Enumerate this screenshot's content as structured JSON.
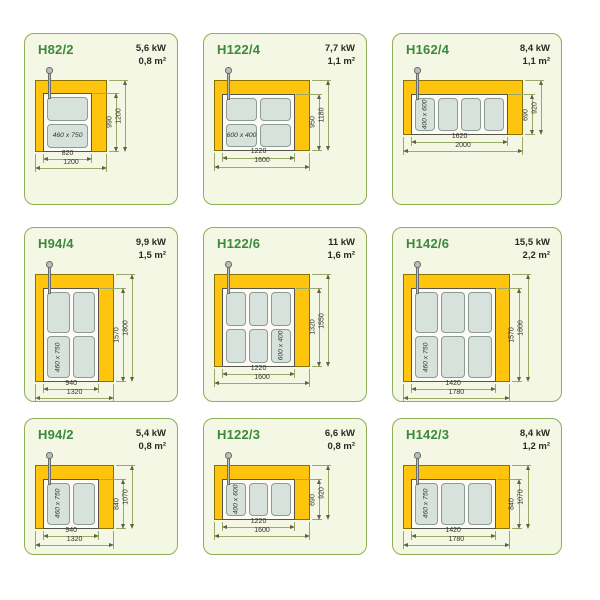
{
  "colors": {
    "page_bg": "#ffffff",
    "panel_bg": "#f4f7e4",
    "panel_border": "#8fae55",
    "title_green": "#3a8a3c",
    "spec_text": "#2b2b25",
    "frame_fill": "#ffc40d",
    "frame_border": "#8a7200",
    "recess_fill": "#fcfcf4",
    "recess_border": "#55554c",
    "plate_fill": "#d8e2dd",
    "plate_border": "#8d9b96",
    "dim_line": "#9aa868",
    "dim_arrow": "#5a6440",
    "dim_text": "#33332d",
    "chimney_fill": "#b9bdbb",
    "chimney_border": "#67706d"
  },
  "cells": [
    {
      "model": "H82/2",
      "power": "5,6 kW",
      "area": "0,8 m²",
      "frame": {
        "outer_w": 1200,
        "outer_h": 1200,
        "inner_w": 820,
        "inner_h": 990
      },
      "dims": {
        "inner_w": 820,
        "outer_w": 1200,
        "inner_h": 990,
        "outer_h": 1200
      },
      "plates": {
        "rows": 2,
        "cols": 1,
        "label": "460 x 750",
        "label_row": 1,
        "label_col": 0,
        "label_rotated": false
      }
    },
    {
      "model": "H122/4",
      "power": "7,7 kW",
      "area": "1,1 m²",
      "frame": {
        "outer_w": 1600,
        "outer_h": 1180,
        "inner_w": 1220,
        "inner_h": 950
      },
      "dims": {
        "inner_w": 1220,
        "outer_w": 1600,
        "inner_h": 950,
        "outer_h": 1180
      },
      "plates": {
        "rows": 2,
        "cols": 2,
        "label": "600 x 400",
        "label_row": 1,
        "label_col": 0,
        "label_rotated": false
      }
    },
    {
      "model": "H162/4",
      "power": "8,4 kW",
      "area": "1,1 m²",
      "frame": {
        "outer_w": 2000,
        "outer_h": 920,
        "inner_w": 1620,
        "inner_h": 690
      },
      "dims": {
        "inner_w": 1620,
        "outer_w": 2000,
        "inner_h": 690,
        "outer_h": 920
      },
      "plates": {
        "rows": 1,
        "cols": 4,
        "label": "400 x 600",
        "label_row": 0,
        "label_col": 0,
        "label_rotated": true
      }
    },
    {
      "model": "H94/4",
      "power": "9,9 kW",
      "area": "1,5 m²",
      "frame": {
        "outer_w": 1320,
        "outer_h": 1800,
        "inner_w": 940,
        "inner_h": 1570
      },
      "dims": {
        "inner_w": 940,
        "outer_w": 1320,
        "inner_h": 1570,
        "outer_h": 1800
      },
      "plates": {
        "rows": 2,
        "cols": 2,
        "label": "460 x 750",
        "label_row": 1,
        "label_col": 0,
        "label_rotated": true
      }
    },
    {
      "model": "H122/6",
      "power": "11 kW",
      "area": "1,6 m²",
      "frame": {
        "outer_w": 1600,
        "outer_h": 1550,
        "inner_w": 1220,
        "inner_h": 1320
      },
      "dims": {
        "inner_w": 1220,
        "outer_w": 1600,
        "inner_h": 1320,
        "outer_h": 1550
      },
      "plates": {
        "rows": 2,
        "cols": 3,
        "label": "600 x 400",
        "label_row": 1,
        "label_col": 2,
        "label_rotated": true
      }
    },
    {
      "model": "H142/6",
      "power": "15,5 kW",
      "area": "2,2 m²",
      "frame": {
        "outer_w": 1780,
        "outer_h": 1800,
        "inner_w": 1420,
        "inner_h": 1570
      },
      "dims": {
        "inner_w": 1420,
        "outer_w": 1780,
        "inner_h": 1570,
        "outer_h": 1800
      },
      "plates": {
        "rows": 2,
        "cols": 3,
        "label": "460 x 750",
        "label_row": 1,
        "label_col": 0,
        "label_rotated": true
      }
    },
    {
      "model": "H94/2",
      "power": "5,4 kW",
      "area": "0,8 m²",
      "frame": {
        "outer_w": 1320,
        "outer_h": 1070,
        "inner_w": 940,
        "inner_h": 840
      },
      "dims": {
        "inner_w": 940,
        "outer_w": 1320,
        "inner_h": 840,
        "outer_h": 1070
      },
      "plates": {
        "rows": 1,
        "cols": 2,
        "label": "460 x 750",
        "label_row": 0,
        "label_col": 0,
        "label_rotated": true
      }
    },
    {
      "model": "H122/3",
      "power": "6,6 kW",
      "area": "0,8 m²",
      "frame": {
        "outer_w": 1600,
        "outer_h": 920,
        "inner_w": 1220,
        "inner_h": 690
      },
      "dims": {
        "inner_w": 1220,
        "outer_w": 1600,
        "inner_h": 690,
        "outer_h": 920
      },
      "plates": {
        "rows": 1,
        "cols": 3,
        "label": "400 x 600",
        "label_row": 0,
        "label_col": 0,
        "label_rotated": true
      }
    },
    {
      "model": "H142/3",
      "power": "8,4 kW",
      "area": "1,2 m²",
      "frame": {
        "outer_w": 1780,
        "outer_h": 1070,
        "inner_w": 1420,
        "inner_h": 840
      },
      "dims": {
        "inner_w": 1420,
        "outer_w": 1780,
        "inner_h": 840,
        "outer_h": 1070
      },
      "plates": {
        "rows": 1,
        "cols": 3,
        "label": "460 x 750",
        "label_row": 0,
        "label_col": 0,
        "label_rotated": true
      }
    }
  ]
}
